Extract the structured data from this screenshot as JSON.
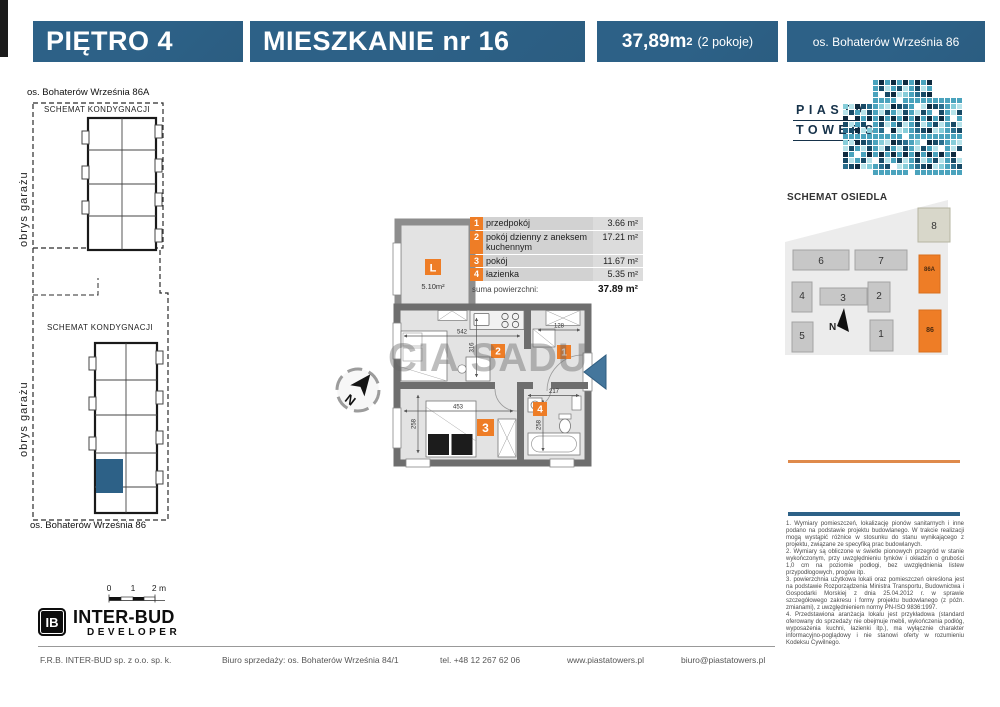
{
  "header": {
    "floor": "PIĘTRO 4",
    "apartment": "MIESZKANIE nr 16",
    "area_value": "37,89m",
    "area_sup": "2",
    "rooms_note": "(2 pokoje)",
    "address": "os. Bohaterów Września 86"
  },
  "left_panel": {
    "top_caption": "os. Bohaterów Września 86A",
    "top_schematic_label": "SCHEMAT KONDYGNACJI",
    "top_garage_label": "obrys garażu",
    "bottom_schematic_label": "SCHEMAT KONDYGNACJI",
    "bottom_garage_label": "obrys garażu",
    "bottom_caption": "os. Bohaterów Września 86"
  },
  "plan": {
    "watermark": "CIA SADU",
    "balcony_label": "L",
    "balcony_area": "5.10m²",
    "north_label": "N",
    "badges": {
      "hall": "1",
      "living": "2",
      "room": "3",
      "bath": "4"
    },
    "dims": {
      "living_width": "542",
      "living_height": "316",
      "hall_width": "128",
      "room_width": "453",
      "room_height": "258",
      "bath_width": "217",
      "bath_height": "258"
    }
  },
  "room_table": {
    "rows": [
      {
        "num": "1",
        "name": "przedpokój",
        "area": "3.66 m²"
      },
      {
        "num": "2",
        "name": "pokój dzienny z aneksem kuchennym",
        "area": "17.21 m²"
      },
      {
        "num": "3",
        "name": "pokój",
        "area": "11.67 m²"
      },
      {
        "num": "4",
        "name": "łazienka",
        "area": "5.35 m²"
      }
    ],
    "total_label": "suma powierzchni:",
    "total_area": "37.89 m²"
  },
  "brand": {
    "logo_line1": "PIASTA",
    "logo_line2": "TOWERS"
  },
  "site_map": {
    "title": "SCHEMAT OSIEDLA",
    "north_label": "N",
    "building_labels": {
      "b1": "1",
      "b2": "2",
      "b3": "3",
      "b4": "4",
      "b5": "5",
      "b6": "6",
      "b7": "7",
      "b8": "8",
      "b86": "86",
      "b86a": "86A"
    }
  },
  "disclaimer": {
    "paragraphs": [
      "1. Wymiary pomieszczeń, lokalizację pionów sanitarnych i inne podano na podstawie projektu budowlanego. W trakcie realizacji mogą wystąpić różnice w stosunku do stanu wynikającego z projektu, związane ze specyfiką prac budowlanych.",
      "2. Wymiary są obliczone w świetle pionowych przegród w stanie wykończonym, przy uwzględnieniu tynków i okładzin o grubości 1,0 cm na poziomie podłogi, bez uwzględnienia listew przypodłogowych, progów itp.",
      "3. powierzchnia użytkowa lokali oraz pomieszczeń określona jest na podstawie Rozporządzenia Ministra Transportu, Budownictwa i Gospodarki Morskiej z dnia 25.04.2012 r. w sprawie szczegółowego zakresu i formy projektu budowlanego (z późn. zmianami), z uwzględnieniem normy PN-ISO 9836:1997.",
      "4. Przedstawiona aranżacja lokalu jest przykładowa (standard oferowany do sprzedaży nie obejmuje mebli, wykończenia podłóg, wyposażenia kuchni, łazienki itp.), ma wyłącznie charakter informacyjno-poglądowy i nie stanowi oferty w rozumieniu Kodeksu Cywilnego."
    ]
  },
  "scale_bar": {
    "l0": "0",
    "l1": "1",
    "l2": "2 m"
  },
  "developer_logo": {
    "monogram": "IB",
    "name": "INTER-BUD",
    "subtitle": "DEVELOPER"
  },
  "footer": {
    "company": "F.R.B. INTER-BUD  sp. z o.o.  sp. k.",
    "sales_office": "Biuro sprzedaży: os. Bohaterów Września 84/1",
    "phone": "tel. +48 12 267 62 06",
    "website": "www.piastatowers.pl",
    "email": "biuro@piastatowers.pl"
  },
  "colors": {
    "header_blue": "#2d6187",
    "accent_orange": "#ee7d26",
    "entry_arrow_blue": "#44769c",
    "unit_highlight_blue": "#2d6187",
    "rule_orange": "#df8a4b",
    "tower_palette": [
      "#0e2a3f",
      "#174a66",
      "#2a6f8e",
      "#4aa3bd",
      "#86cdd9",
      "#b7e3ea"
    ]
  }
}
